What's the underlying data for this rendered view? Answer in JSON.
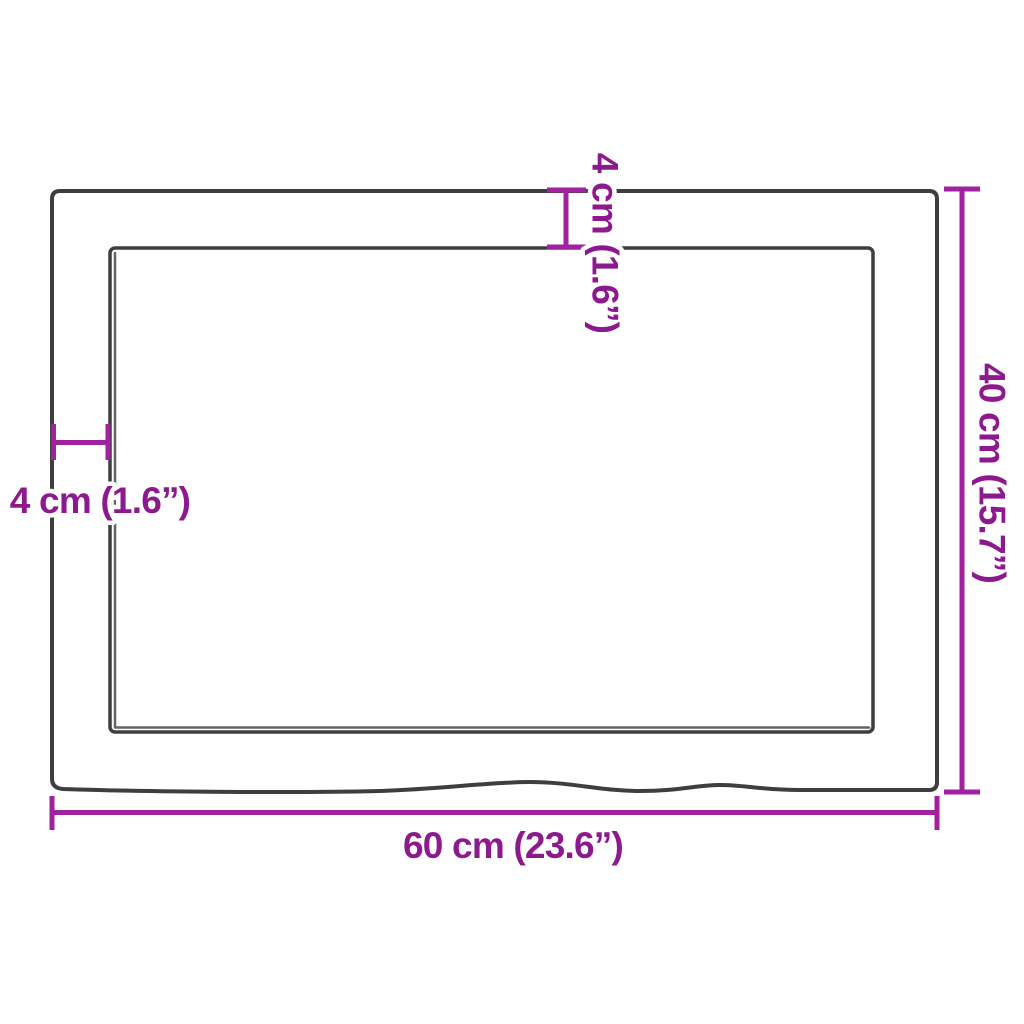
{
  "diagram": {
    "background": "#ffffff",
    "outline_color": "#3e3e3e",
    "shadow_color": "#636363",
    "dimension_line_color": "#a1219f",
    "label_color": "#8c1a8e",
    "labels": {
      "width": "60 cm (23.6”)",
      "depth": "40 cm (15.7”)",
      "thickness_top": "4 cm (1.6”)",
      "thickness_left": "4 cm (1.6”)"
    },
    "measurements": {
      "width_cm": 60,
      "width_in": 23.6,
      "depth_cm": 40,
      "depth_in": 15.7,
      "edge_cm": 4,
      "edge_in": 1.6
    }
  }
}
